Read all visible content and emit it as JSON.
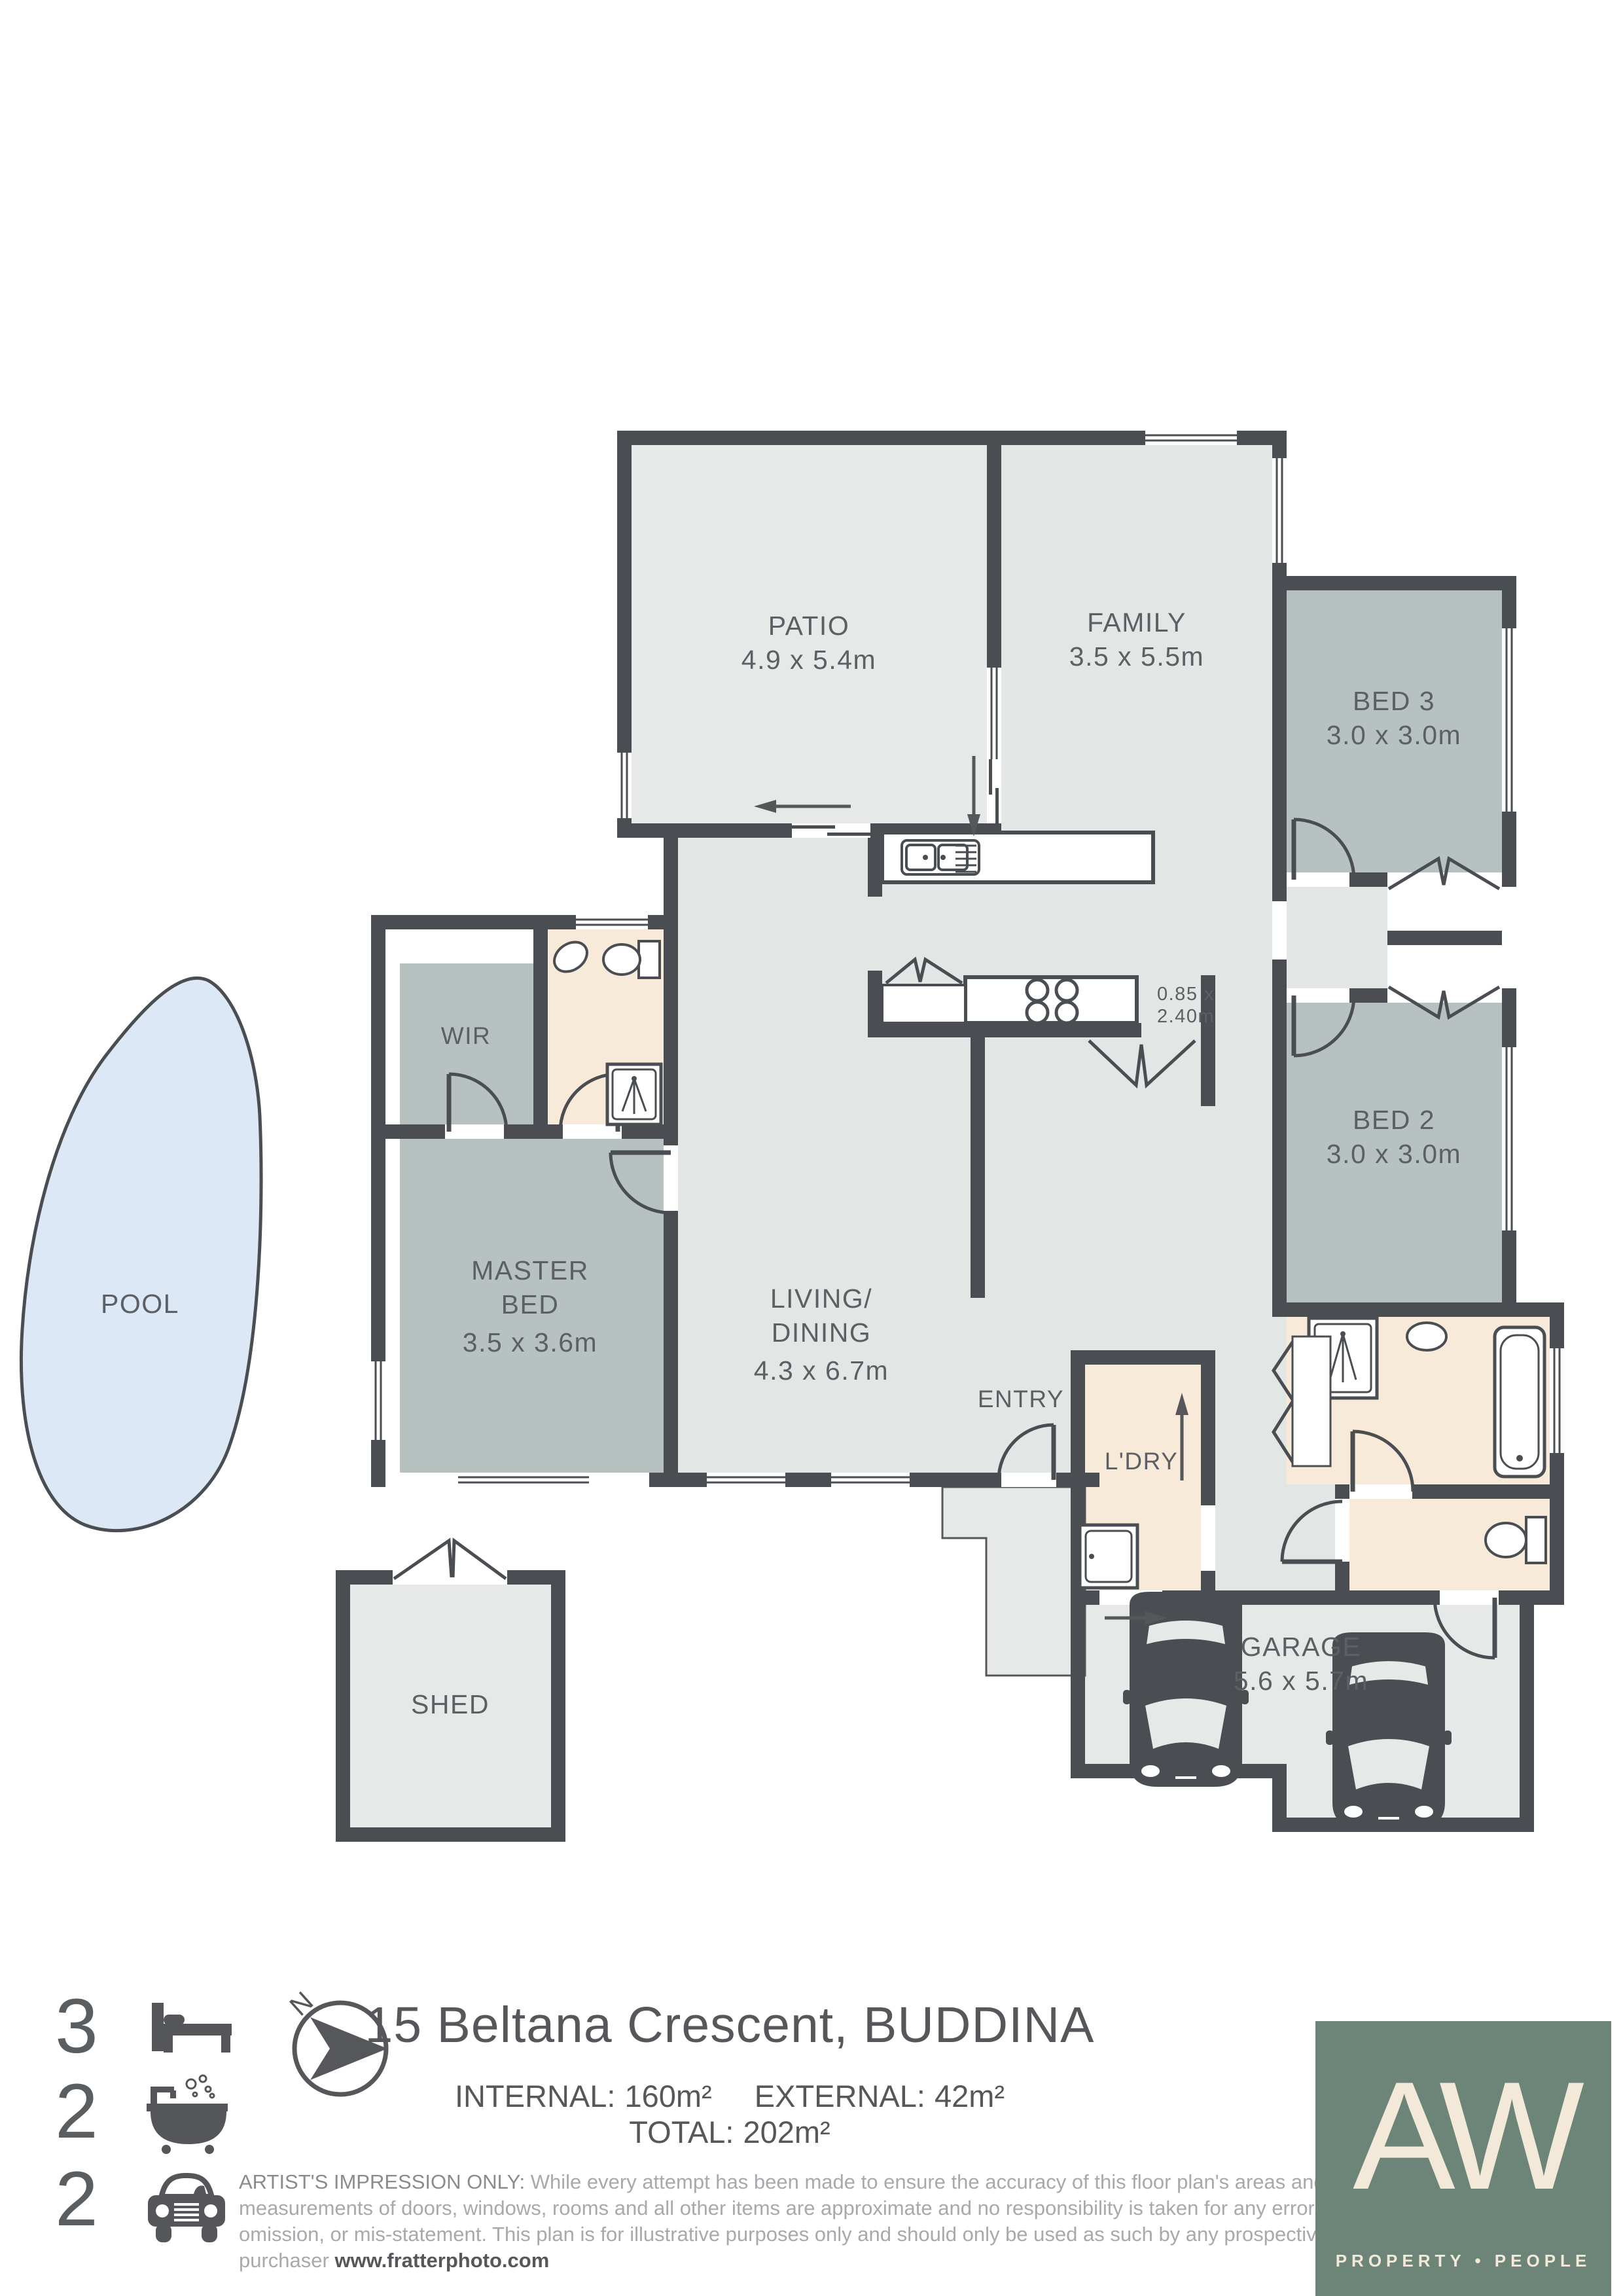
{
  "plan": {
    "rooms": {
      "patio": {
        "name": "PATIO",
        "dims": "4.9 x 5.4m"
      },
      "family": {
        "name": "FAMILY",
        "dims": "3.5 x 5.5m"
      },
      "bed3": {
        "name": "BED 3",
        "dims": "3.0 x 3.0m"
      },
      "bed2": {
        "name": "BED 2",
        "dims": "3.0 x 3.0m"
      },
      "master": {
        "name1": "MASTER",
        "name2": "BED",
        "dims": "3.5 x 3.6m"
      },
      "living": {
        "name1": "LIVING/",
        "name2": "DINING",
        "dims": "4.3 x 6.7m"
      },
      "wir": {
        "name": "WIR"
      },
      "ldry": {
        "name": "L'DRY"
      },
      "entry": {
        "name": "ENTRY"
      },
      "garage": {
        "name": "GARAGE",
        "dims": "5.6 x 5.7m"
      },
      "pool": {
        "name": "POOL"
      },
      "shed": {
        "name": "SHED"
      },
      "bench": {
        "dims1": "0.85 x",
        "dims2": "2.40m"
      }
    },
    "compass": {
      "north_label": "N"
    }
  },
  "footer": {
    "beds": "3",
    "baths": "2",
    "cars": "2",
    "title": "15 Beltana Crescent, BUDDINA",
    "stats": [
      {
        "label": "INTERNAL:",
        "value": "160m²"
      },
      {
        "label": "EXTERNAL:",
        "value": "42m²"
      },
      {
        "label": "TOTAL:",
        "value": "202m²"
      }
    ],
    "disclaimer_lead": "ARTIST'S IMPRESSION ONLY:",
    "disclaimer_body": " While every attempt has been made to ensure the accuracy of this floor plan's areas and measurements of doors, windows, rooms and all other items are approximate and no responsibility is taken for any error, omission, or mis-statement. This plan is for illustrative purposes only and should only be used as such by any prospective purchaser ",
    "disclaimer_link": "www.fratterphoto.com",
    "logo": {
      "text": "AW",
      "tagline": "PROPERTY • PEOPLE"
    }
  },
  "colors": {
    "wall": "#4a4e52",
    "internal_floor": "#e2e6e5",
    "external_floor": "#e7e8e8",
    "bedroom_floor": "#b7c2c0",
    "wet_area_floor": "#f8ead9",
    "pool_water": "#dce8f5",
    "logo_background": "#6d8478",
    "logo_cream": "#f2e9d8",
    "text_dark": "#55575a",
    "text_muted": "#a7a9ac"
  }
}
